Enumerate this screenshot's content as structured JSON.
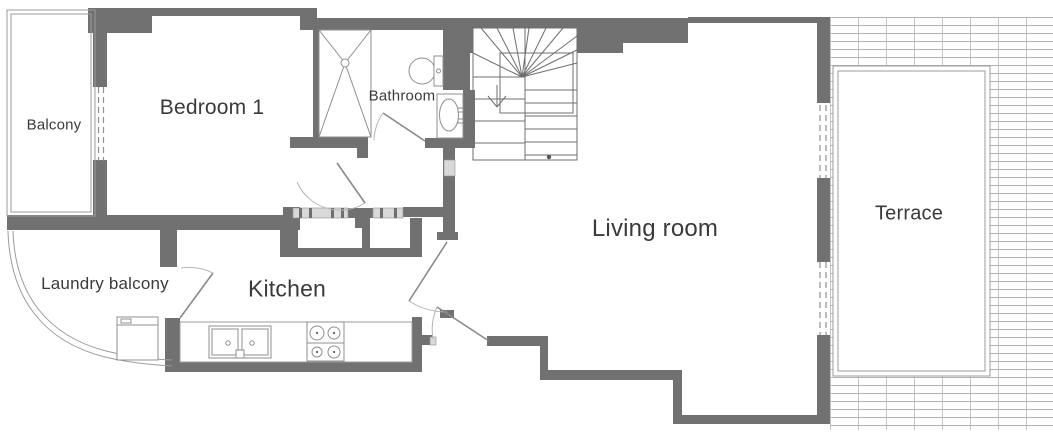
{
  "floorplan": {
    "type": "apartment-floor-plan",
    "rooms": [
      {
        "name": "balcony",
        "label": "Balcony"
      },
      {
        "name": "bedroom-1",
        "label": "Bedroom 1"
      },
      {
        "name": "bathroom",
        "label": "Bathroom"
      },
      {
        "name": "laundry-balcony",
        "label": "Laundry balcony"
      },
      {
        "name": "kitchen",
        "label": "Kitchen"
      },
      {
        "name": "living-room",
        "label": "Living room"
      },
      {
        "name": "terrace",
        "label": "Terrace"
      }
    ],
    "fixtures": [
      "shower",
      "toilet",
      "bathroom-sink",
      "staircase",
      "kitchen-sink",
      "stove",
      "washing-machine",
      "kitchen-counter"
    ],
    "colors": {
      "wall": "#717171",
      "outline": "#9b9b9b",
      "tile_line": "#b3b3b3",
      "window_fill": "#d9d9d9",
      "text": "#3a3a3a",
      "background": "#ffffff"
    }
  }
}
